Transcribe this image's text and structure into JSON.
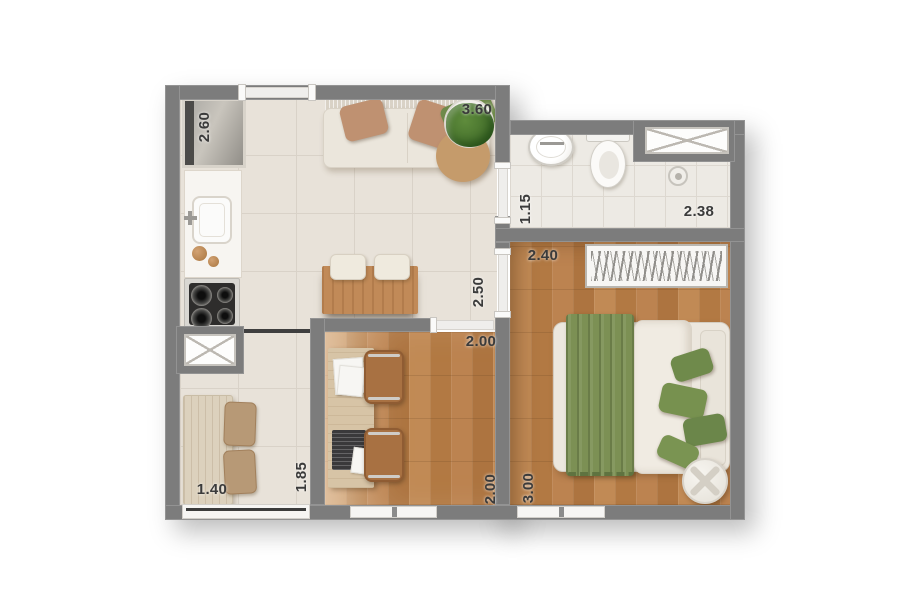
{
  "dims": {
    "kitchen_length": "2.60",
    "living_width": "3.60",
    "bathroom_entry_depth": "1.15",
    "bathroom_width": "2.38",
    "bedroom_width": "2.40",
    "bedroom_length": "3.00",
    "living_depth": "2.50",
    "office_width": "2.00",
    "office_length": "2.00",
    "dining_width": "1.40",
    "dining_length": "1.85"
  },
  "colors": {
    "wall": "#7c7c7c",
    "tile_floor": "#e8e2d9",
    "bathroom_floor": "#edeae4",
    "wood_floor": "#b97f4a",
    "accent_green": "#7c9054",
    "label_text": "#3b3b3b",
    "background": "#ffffff"
  },
  "furniture_icons": [
    "fridge",
    "kitchen-counter",
    "sink",
    "cooktop",
    "shaft-window",
    "sofa",
    "throw-pillows",
    "plant",
    "sideboard",
    "stools",
    "dining-table",
    "dining-chairs",
    "desk",
    "papers",
    "laptop",
    "office-chairs",
    "wardrobe",
    "double-bed",
    "blanket",
    "duvet",
    "bed-pillows",
    "round-side-table",
    "washbasin",
    "toilet",
    "shower-drain",
    "window",
    "door"
  ]
}
